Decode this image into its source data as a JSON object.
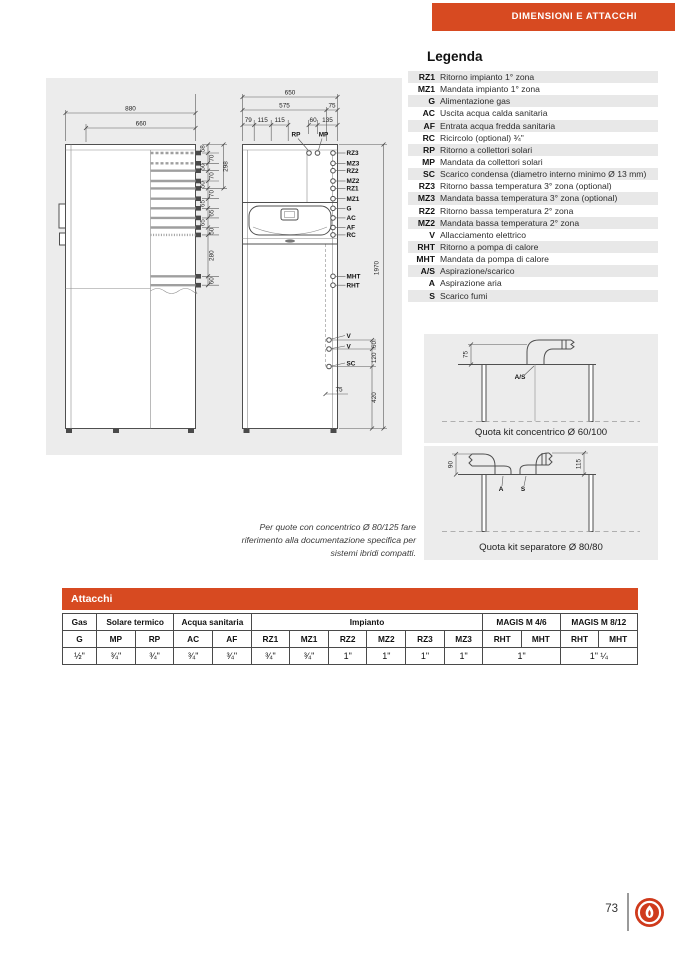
{
  "header": {
    "banner": "DIMENSIONI E ATTACCHI"
  },
  "colors": {
    "accent": "#d74a21",
    "panel_bg": "#ececec",
    "row_alt": "#e8e8e8",
    "logo_red": "#cf3a1c"
  },
  "legend": {
    "title": "Legenda",
    "items": [
      {
        "abbr": "RZ1",
        "desc": "Ritorno impianto 1° zona"
      },
      {
        "abbr": "MZ1",
        "desc": "Mandata impianto 1° zona"
      },
      {
        "abbr": "G",
        "desc": "Alimentazione gas"
      },
      {
        "abbr": "AC",
        "desc": "Uscita acqua calda sanitaria"
      },
      {
        "abbr": "AF",
        "desc": "Entrata acqua fredda sanitaria"
      },
      {
        "abbr": "RC",
        "desc": "Ricircolo (optional) ¾\""
      },
      {
        "abbr": "RP",
        "desc": "Ritorno a collettori solari"
      },
      {
        "abbr": "MP",
        "desc": "Mandata da collettori solari"
      },
      {
        "abbr": "SC",
        "desc": "Scarico condensa (diametro interno minimo Ø 13 mm)"
      },
      {
        "abbr": "RZ3",
        "desc": "Ritorno bassa temperatura 3° zona (optional)"
      },
      {
        "abbr": "MZ3",
        "desc": "Mandata bassa temperatura 3° zona (optional)"
      },
      {
        "abbr": "RZ2",
        "desc": "Ritorno bassa temperatura 2° zona"
      },
      {
        "abbr": "MZ2",
        "desc": "Mandata bassa temperatura 2° zona"
      },
      {
        "abbr": "V",
        "desc": "Allacciamento elettrico"
      },
      {
        "abbr": "RHT",
        "desc": "Ritorno a pompa di calore"
      },
      {
        "abbr": "MHT",
        "desc": "Mandata da pompa di calore"
      },
      {
        "abbr": "A/S",
        "desc": "Aspirazione/scarico"
      },
      {
        "abbr": "A",
        "desc": "Aspirazione aria"
      },
      {
        "abbr": "S",
        "desc": "Scarico fumi"
      }
    ]
  },
  "drawings": {
    "side_view": {
      "width_total": "880",
      "width_inner": "660",
      "h_top": "58",
      "chain": [
        "70",
        "50",
        "70",
        "50",
        "70",
        "65",
        "65",
        "65",
        "50",
        "280",
        "60"
      ],
      "h_group": "298"
    },
    "front_view": {
      "w_total": "650",
      "w_left": "575",
      "w_right": "75",
      "top_offsets": [
        "79",
        "115",
        "115",
        "60",
        "135"
      ],
      "rp": "RP",
      "mp": "MP",
      "pipes": [
        "RZ3",
        "MZ3",
        "RZ2",
        "MZ2",
        "RZ1",
        "MZ1",
        "G",
        "AC",
        "AF",
        "RC"
      ],
      "hp_pipes": [
        "MHT",
        "RHT"
      ],
      "bottom_pipes": [
        "V",
        "V",
        "SC"
      ],
      "h_total": "1970",
      "bottom_chain": [
        "60",
        "120",
        "420"
      ],
      "sc_offset": "75"
    },
    "kit_concentrico": {
      "title": "Quota kit concentrico Ø 60/100",
      "dim": "75",
      "label": "A/S"
    },
    "kit_separatore": {
      "title": "Quota kit separatore Ø 80/80",
      "dim_left": "90",
      "dim_right": "115",
      "label_a": "A",
      "label_s": "S"
    }
  },
  "note": {
    "lines": [
      "Per quote con concentrico Ø 80/125 fare",
      "riferimento alla documentazione specifica per",
      "sistemi ibridi compatti."
    ]
  },
  "attacchi_table": {
    "title": "Attacchi",
    "groups": [
      {
        "label": "Gas"
      },
      {
        "label": "Solare termico"
      },
      {
        "label": "Acqua sanitaria"
      },
      {
        "label": "Impianto"
      },
      {
        "label": "MAGIS M 4/6"
      },
      {
        "label": "MAGIS M 8/12"
      }
    ],
    "subheaders": [
      "G",
      "MP",
      "RP",
      "AC",
      "AF",
      "RZ1",
      "MZ1",
      "RZ2",
      "MZ2",
      "RZ3",
      "MZ3",
      "RHT",
      "MHT",
      "RHT",
      "MHT"
    ],
    "values": [
      "½\"",
      "¾\"",
      "¾\"",
      "¾\"",
      "¾\"",
      "¾\"",
      "¾\"",
      "1\"",
      "1\"",
      "1\"",
      "1\"",
      "1\"",
      "1\" ¼"
    ]
  },
  "footer": {
    "page_number": "73",
    "logo": "immergas-flame-logo"
  }
}
